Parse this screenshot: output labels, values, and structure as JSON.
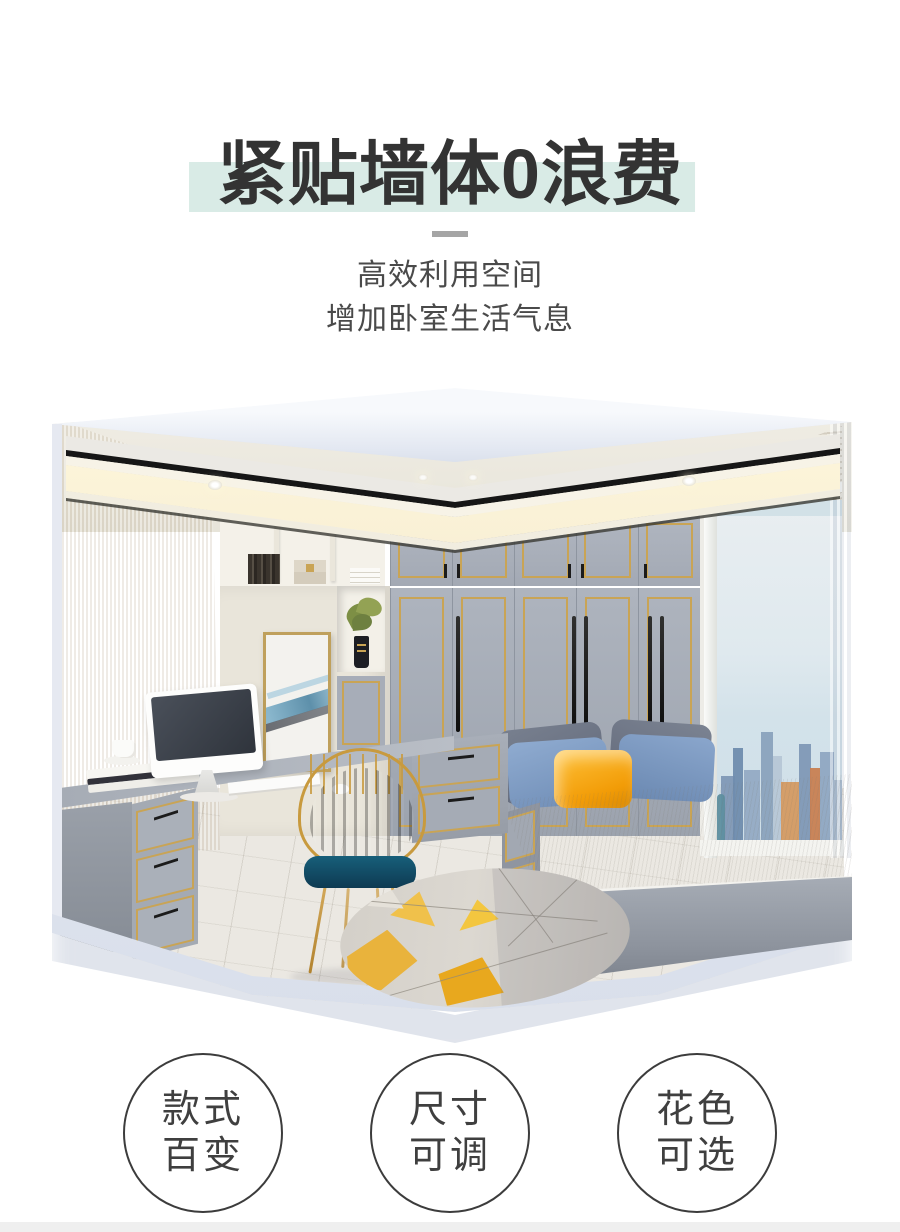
{
  "header": {
    "title": "紧贴墙体0浪费",
    "subtitle1": "高效利用空间",
    "subtitle2": "增加卧室生活气息"
  },
  "features": [
    {
      "line1": "款式",
      "line2": "百变"
    },
    {
      "line1": "尺寸",
      "line2": "可调"
    },
    {
      "line1": "花色",
      "line2": "可选"
    }
  ],
  "colors": {
    "mint": "#d9ebe6",
    "title": "#333333",
    "text": "#4a4a4a",
    "divider": "#a5a5a5",
    "frame": "#dfe4ee",
    "gold": "#c9a455",
    "handle": "#1b1b1b",
    "wardrobe": "#a7adb8",
    "wood": "#d6c5a6",
    "cream": "#e9e5da",
    "floor": "#ebe8e2",
    "mattress": "#d8d4ca",
    "bedBase": "#9aa0aa",
    "pillowSlate": "#6b7383",
    "pillowBlue": "#7e9cc4",
    "pillowOrange": "#f2a31c",
    "chairTeal": "#15607c",
    "sky": "#e7edf1",
    "footer": "#efefef",
    "circleBorder": "#3c3c3c"
  }
}
